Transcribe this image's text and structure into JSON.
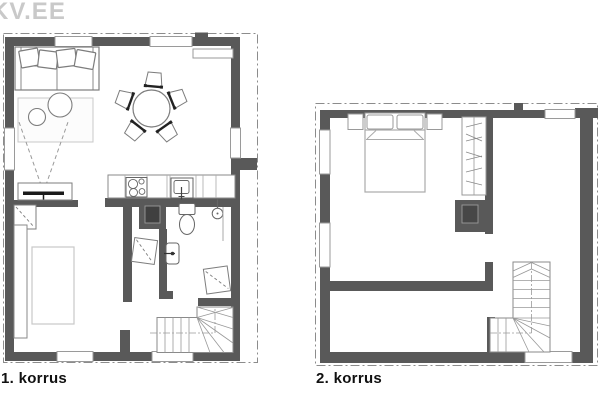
{
  "watermark": {
    "text": "KV.EE",
    "color": "#c9c9c9"
  },
  "floors": [
    {
      "label": "1. korrus",
      "furniture": [
        "sofa",
        "rug",
        "coffee-tables",
        "dining-table-with-5-chairs",
        "tv-bench",
        "kitchen-counter",
        "cooktop",
        "kitchen-sink",
        "sauna-stove",
        "toilet",
        "washbasin",
        "shower",
        "storage-cabinets",
        "wardrobe",
        "bed",
        "winder-stairs"
      ]
    },
    {
      "label": "2. korrus",
      "furniture": [
        "double-bed",
        "nightstands",
        "pillows",
        "wardrobe",
        "chimney-fireplace",
        "winder-stairs"
      ]
    }
  ],
  "colors": {
    "wall": "#595959",
    "furniture_outline": "#7d7d7d",
    "light_outline": "#c8c8c8",
    "boundary_line": "#8c8c8c",
    "label": "#111111",
    "background": "#ffffff"
  }
}
